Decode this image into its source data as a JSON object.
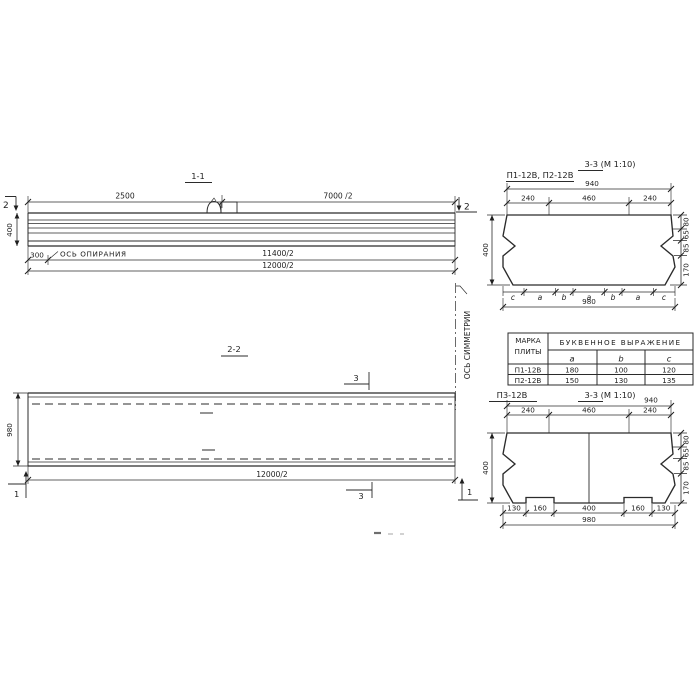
{
  "view_1_1": {
    "title": "1-1",
    "cut_left": "2",
    "cut_right": "2",
    "dim_2500": "2500",
    "dim_7000": "7000 /2",
    "dim_400": "400",
    "dim_300": "300",
    "support_axis_label": "ОСЬ ОПИРАНИЯ",
    "dim_11400": "11400/2",
    "dim_12000": "12000/2"
  },
  "axis_of_symmetry_label": "ОСЬ СИММЕТРИИ",
  "view_2_2": {
    "title": "2-2",
    "dim_980": "980",
    "dim_12000": "12000/2",
    "cut_top": "3",
    "cut_bottom": "3",
    "cut_left": "1",
    "cut_right": "1"
  },
  "section_p12": {
    "label": "П1-12В, П2-12В",
    "title": "3-3 (М 1:10)",
    "dim_940": "940",
    "top_chain": [
      "240",
      "460",
      "240"
    ],
    "dim_400": "400",
    "right_chain": [
      "80",
      "65",
      "85",
      "170"
    ],
    "letter_chain": [
      "c",
      "a",
      "b",
      "a",
      "b",
      "a",
      "c"
    ],
    "dim_980": "980"
  },
  "table": {
    "col1_header_line1": "МАРКА",
    "col1_header_line2": "ПЛИТЫ",
    "span_header": "БУКВЕННОЕ ВЫРАЖЕНИЕ",
    "columns": [
      "a",
      "b",
      "c"
    ],
    "rows": [
      {
        "mark": "П1-12В",
        "a": "180",
        "b": "100",
        "c": "120"
      },
      {
        "mark": "П2-12В",
        "a": "150",
        "b": "130",
        "c": "135"
      }
    ]
  },
  "section_p3": {
    "label": "П3-12В",
    "title": "3-3 (М 1:10)",
    "dim_940": "940",
    "top_chain": [
      "240",
      "460",
      "240"
    ],
    "dim_400": "400",
    "right_chain": [
      "80",
      "65",
      "85",
      "170"
    ],
    "bottom_chain": [
      "130",
      "160",
      "400",
      "160",
      "130"
    ],
    "dim_980": "980"
  }
}
